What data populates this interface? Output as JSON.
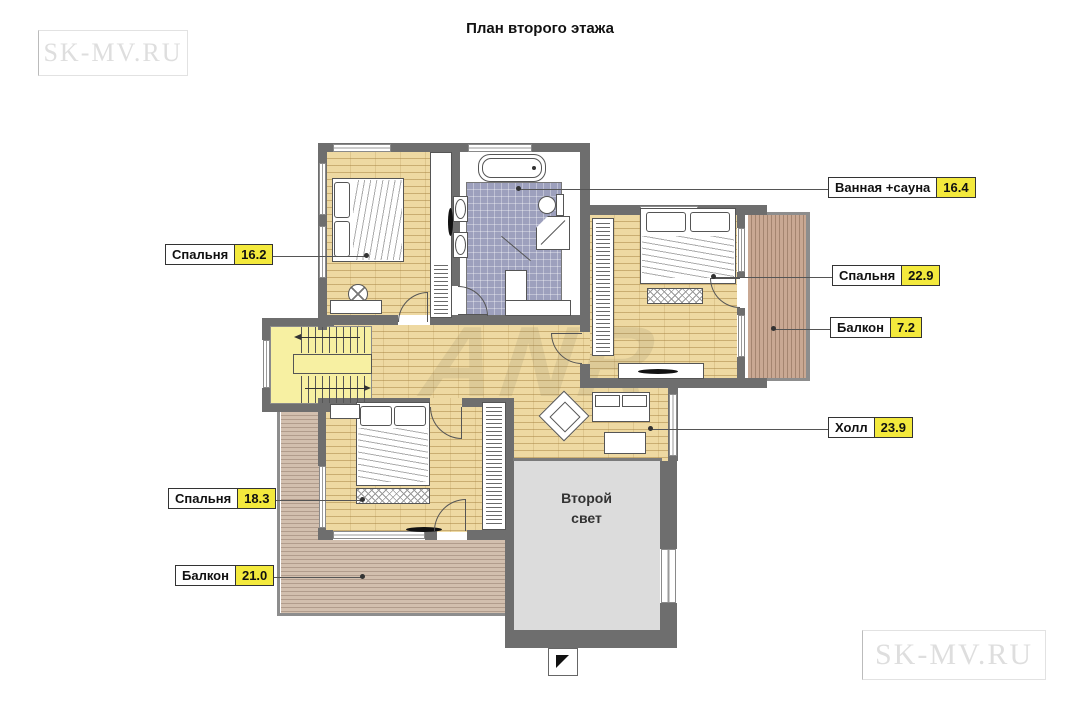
{
  "title": "План второго этажа",
  "watermark": {
    "top_left": "SK-MV.RU",
    "bottom_right": "SK-MV.RU",
    "center": "ANR"
  },
  "labels": [
    {
      "name": "Ванная +сауна",
      "area": "16.4"
    },
    {
      "name": "Спальня",
      "area": "22.9"
    },
    {
      "name": "Балкон",
      "area": "7.2"
    },
    {
      "name": "Холл",
      "area": "23.9"
    },
    {
      "name": "Спальня",
      "area": "16.2"
    },
    {
      "name": "Спальня",
      "area": "18.3"
    },
    {
      "name": "Балкон",
      "area": "21.0"
    }
  ],
  "second_light": {
    "line1": "Второй",
    "line2": "свет"
  },
  "colors": {
    "wall": "#6e6e6e",
    "wood": "#eed9a2",
    "tile": "#9da0bd",
    "stairs": "#f7f0a2",
    "deck_bottom": "#d2bfae",
    "deck_right": "#c9a893",
    "second_light": "#dcdcdc",
    "area_badge": "#f3e93c"
  }
}
